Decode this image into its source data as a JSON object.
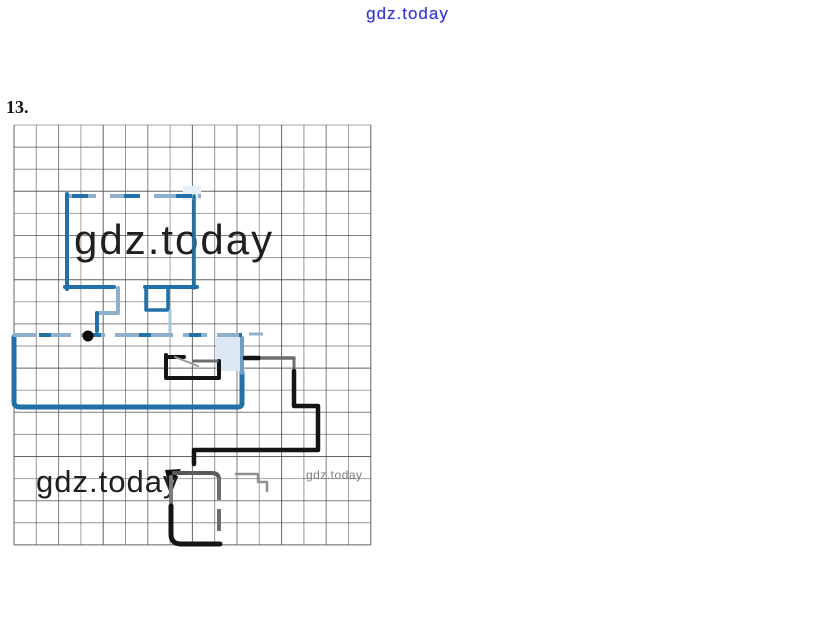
{
  "page": {
    "header_watermark": "gdz.today",
    "problem_number": "13.",
    "watermark_large": "gdz.today",
    "watermark_bottom": "gdz.today",
    "watermark_small": "gdz.today"
  },
  "colors": {
    "watermark_blue": "#3535cf",
    "figure_blue": "#2270a8",
    "figure_blue_light": "#8fb0cd",
    "ink_black": "#141414",
    "ink_gray": "#6e6e6e",
    "grid_line": "#4a4a4a"
  },
  "figure": {
    "grid": {
      "x": 14,
      "y": 125,
      "cols": 16,
      "rows": 19,
      "cell_w": 22.3,
      "cell_h": 22.1,
      "line_color": "#4a4a4a"
    },
    "fills": [
      {
        "name": "pale-fill-rect-top-right",
        "d": "M216,336 H242 V371 H216 Z",
        "color": "#dce8f3"
      },
      {
        "name": "pale-fill-upper-corner",
        "d": "M183,186 H201 V200 H183 Z",
        "color": "#e6eef6"
      },
      {
        "name": "corner-flag",
        "d": "M165,470 L181,469 L169,487 Z",
        "color": "#101010"
      }
    ],
    "dot": {
      "cx": 88,
      "cy": 336,
      "r": 5.5,
      "color": "#0a0a0a"
    },
    "paths": [
      {
        "name": "rectA-top-light",
        "d": "M66,196 H201",
        "color": "#8fb0cd",
        "w": 4,
        "dash": "30 14",
        "cap": "butt"
      },
      {
        "name": "rectA-top-dark",
        "d": "M66,196 H201",
        "color": "#2270a8",
        "w": 4,
        "dash": "16 36",
        "offset": -6,
        "cap": "butt"
      },
      {
        "name": "rectA-left",
        "d": "M67,194 V289",
        "color": "#2270a8",
        "w": 4
      },
      {
        "name": "rectA-right",
        "d": "M194,196 V288",
        "color": "#2270a8",
        "w": 3.5
      },
      {
        "name": "rectA-bottom-left",
        "d": "M65,287 H114",
        "color": "#2270a8",
        "w": 4
      },
      {
        "name": "rectA-bottom-right",
        "d": "M145,287 H197",
        "color": "#2270a8",
        "w": 4
      },
      {
        "name": "rectA-notch",
        "d": "M146,289 V310 H168 V289",
        "color": "#2270a8",
        "w": 3.5
      },
      {
        "name": "connector-elbow-light",
        "d": "M118,288 V313 H98",
        "color": "#8fb0cd",
        "w": 4
      },
      {
        "name": "connector-drop",
        "d": "M97,313 V331",
        "color": "#2270a8",
        "w": 4
      },
      {
        "name": "connector-right-faint",
        "d": "M170,311 V332",
        "color": "#a9c6db",
        "w": 3
      },
      {
        "name": "rectB-outline",
        "d": "M14,337 V402 Q14,407 20,407 H238 Q242,407 242,403 V372",
        "color": "#2270a8",
        "w": 5
      },
      {
        "name": "rectB-right-upper",
        "d": "M242,373 V338",
        "color": "#6f9ec4",
        "w": 4
      },
      {
        "name": "rectB-top-light",
        "d": "M13,335 H242",
        "color": "#8fb0cd",
        "w": 4,
        "dash": "24 10",
        "cap": "butt"
      },
      {
        "name": "rectB-top-dark",
        "d": "M13,335 H242",
        "color": "#2270a8",
        "w": 4,
        "dash": "12 38",
        "offset": -26,
        "cap": "butt"
      },
      {
        "name": "rectB-top-ext-dash",
        "d": "M249,334 H263",
        "color": "#8fb0cd",
        "w": 3,
        "cap": "butt"
      },
      {
        "name": "shapeC-bracket",
        "d": "M166,357 H184 M166,355 V378 H219 V361",
        "color": "#141414",
        "w": 4
      },
      {
        "name": "shapeC-gray-top",
        "d": "M194,361 H217",
        "color": "#6e6e6e",
        "w": 3
      },
      {
        "name": "shapeC-diagonal",
        "d": "M175,357 L198,366",
        "color": "#9a9a9a",
        "w": 2
      },
      {
        "name": "pathD-dash",
        "d": "M245,358 H259",
        "color": "#141414",
        "w": 4.5
      },
      {
        "name": "pathD-gray-h",
        "d": "M262,358 H294",
        "color": "#6e6e6e",
        "w": 3.5
      },
      {
        "name": "pathD-gray-v",
        "d": "M294,358 V371",
        "color": "#6e6e6e",
        "w": 3
      },
      {
        "name": "pathD-black",
        "d": "M294,371 V406 H318 V450 H194 V464",
        "color": "#141414",
        "w": 4.5
      },
      {
        "name": "shapeE-top",
        "d": "M174,473 H212 Q218,473 219,478",
        "color": "#5a5a5a",
        "w": 4
      },
      {
        "name": "shapeE-right",
        "d": "M219,478 V534",
        "color": "#6e6e6e",
        "w": 4,
        "dash": "22 9",
        "cap": "butt"
      },
      {
        "name": "shapeE-left",
        "d": "M171,477 V520",
        "color": "#7a7a7a",
        "w": 4
      },
      {
        "name": "shapeE-black",
        "d": "M171,506 V534 Q171,544 181,544 H220",
        "color": "#141414",
        "w": 5
      },
      {
        "name": "shapeF-steps",
        "d": "M236,474 H258 V482 H267 V491",
        "color": "#8f8f8f",
        "w": 2.5
      }
    ]
  }
}
